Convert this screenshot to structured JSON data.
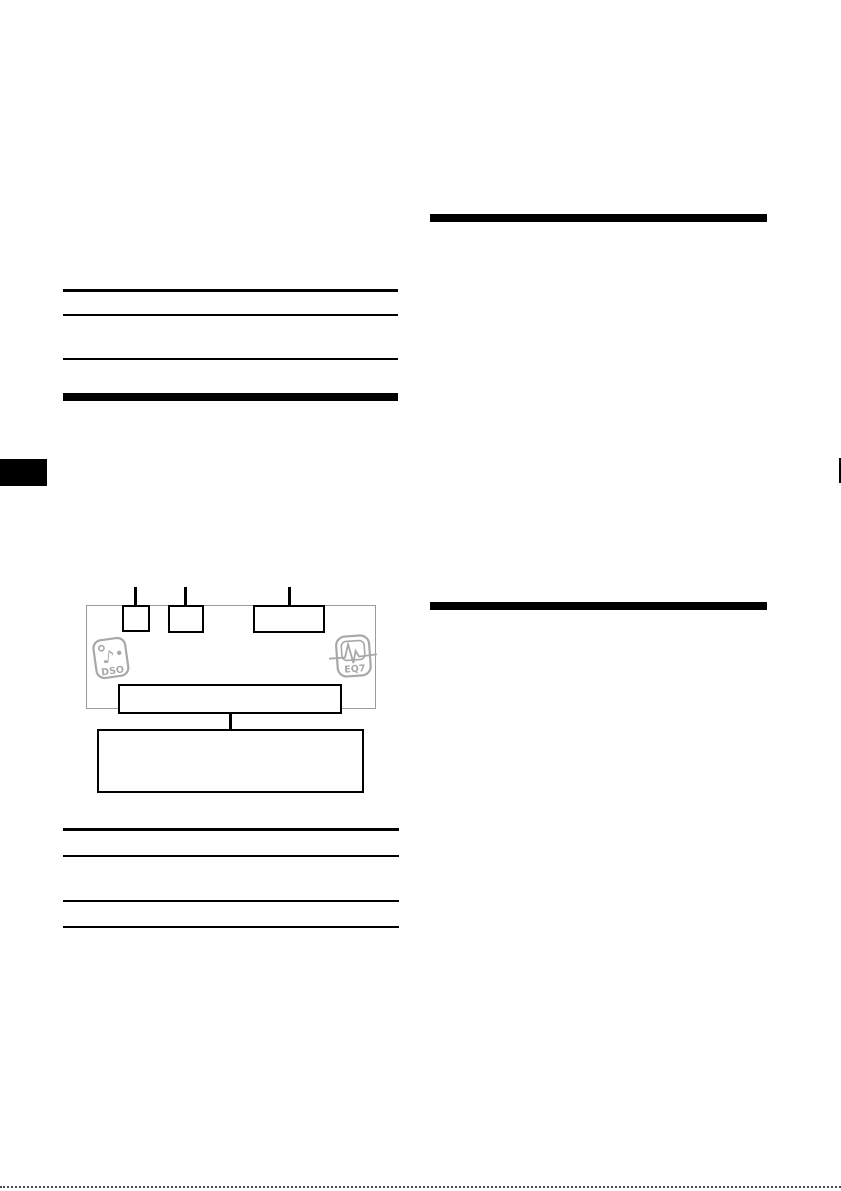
{
  "page": {
    "background": "#ffffff",
    "kind_label": ""
  },
  "colors": {
    "ink": "#000000",
    "panel_outline_gray": "#9c9c9c",
    "badge_gray": "#a8a8a8",
    "cut_line_gray": "#4a4a4a"
  },
  "diagram": {
    "dso_badge": {
      "label": "DSO",
      "note_glyph": "♪"
    },
    "eq7_badge": {
      "label": "EQ7"
    }
  }
}
